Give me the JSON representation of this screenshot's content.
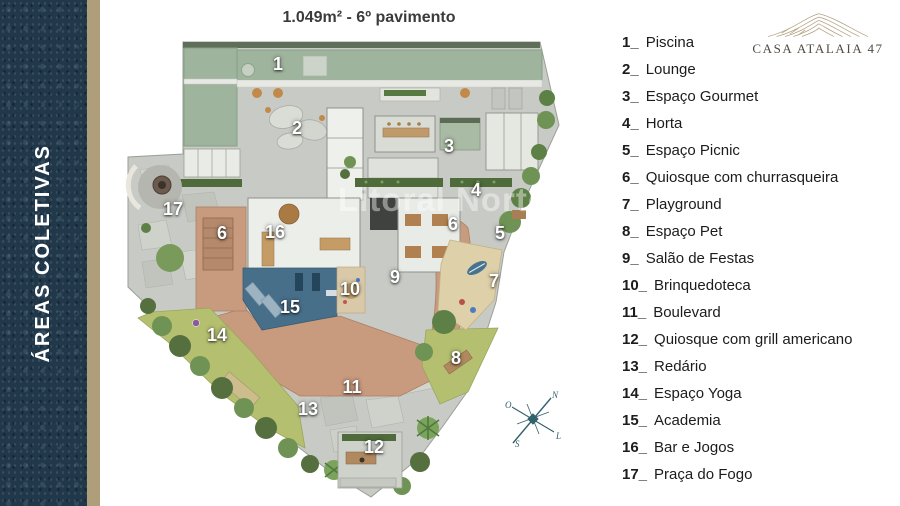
{
  "sidebar": {
    "title": "ÁREAS COLETIVAS",
    "band_color": "#20384a",
    "stripe_color": "#ae9e79"
  },
  "plan": {
    "title": "1.049m² - 6º pavimento",
    "watermark": "Litoral Norte",
    "compass": {
      "n": "N",
      "l": "L",
      "s": "S",
      "o": "O"
    },
    "markers": [
      {
        "label": "1",
        "x": 278,
        "y": 64
      },
      {
        "label": "2",
        "x": 297,
        "y": 128
      },
      {
        "label": "3",
        "x": 449,
        "y": 146
      },
      {
        "label": "4",
        "x": 476,
        "y": 190
      },
      {
        "label": "5",
        "x": 500,
        "y": 233
      },
      {
        "label": "6",
        "x": 222,
        "y": 233
      },
      {
        "label": "6",
        "x": 453,
        "y": 224
      },
      {
        "label": "7",
        "x": 494,
        "y": 281
      },
      {
        "label": "8",
        "x": 456,
        "y": 358
      },
      {
        "label": "9",
        "x": 395,
        "y": 277
      },
      {
        "label": "10",
        "x": 350,
        "y": 289
      },
      {
        "label": "11",
        "x": 352,
        "y": 387
      },
      {
        "label": "12",
        "x": 374,
        "y": 447
      },
      {
        "label": "13",
        "x": 308,
        "y": 409
      },
      {
        "label": "14",
        "x": 217,
        "y": 335
      },
      {
        "label": "15",
        "x": 290,
        "y": 307
      },
      {
        "label": "16",
        "x": 275,
        "y": 232
      },
      {
        "label": "17",
        "x": 173,
        "y": 209
      }
    ],
    "colors": {
      "pool": "#9fb49d",
      "deck_wood": "#c89a7e",
      "gym_floor": "#486f8a",
      "lawn": "#b5bf70",
      "concrete": "#c8cac5"
    }
  },
  "legend": {
    "items": [
      {
        "num": "1_",
        "label": "Piscina"
      },
      {
        "num": "2_",
        "label": "Lounge"
      },
      {
        "num": "3_",
        "label": "Espaço Gourmet"
      },
      {
        "num": "4_",
        "label": "Horta"
      },
      {
        "num": "5_",
        "label": "Espaço Picnic"
      },
      {
        "num": "6_",
        "label": "Quiosque com churrasqueira"
      },
      {
        "num": "7_",
        "label": "Playground"
      },
      {
        "num": "8_",
        "label": "Espaço Pet"
      },
      {
        "num": "9_",
        "label": "Salão de Festas"
      },
      {
        "num": "10_",
        "label": "Brinquedoteca"
      },
      {
        "num": "11_",
        "label": "Boulevard"
      },
      {
        "num": "12_",
        "label": "Quiosque com grill americano"
      },
      {
        "num": "13_",
        "label": "Redário"
      },
      {
        "num": "14_",
        "label": "Espaço Yoga"
      },
      {
        "num": "15_",
        "label": "Academia"
      },
      {
        "num": "16_",
        "label": "Bar e Jogos"
      },
      {
        "num": "17_",
        "label": "Praça do Fogo"
      }
    ]
  },
  "logo": {
    "text": "CASA ATALAIA 47"
  }
}
